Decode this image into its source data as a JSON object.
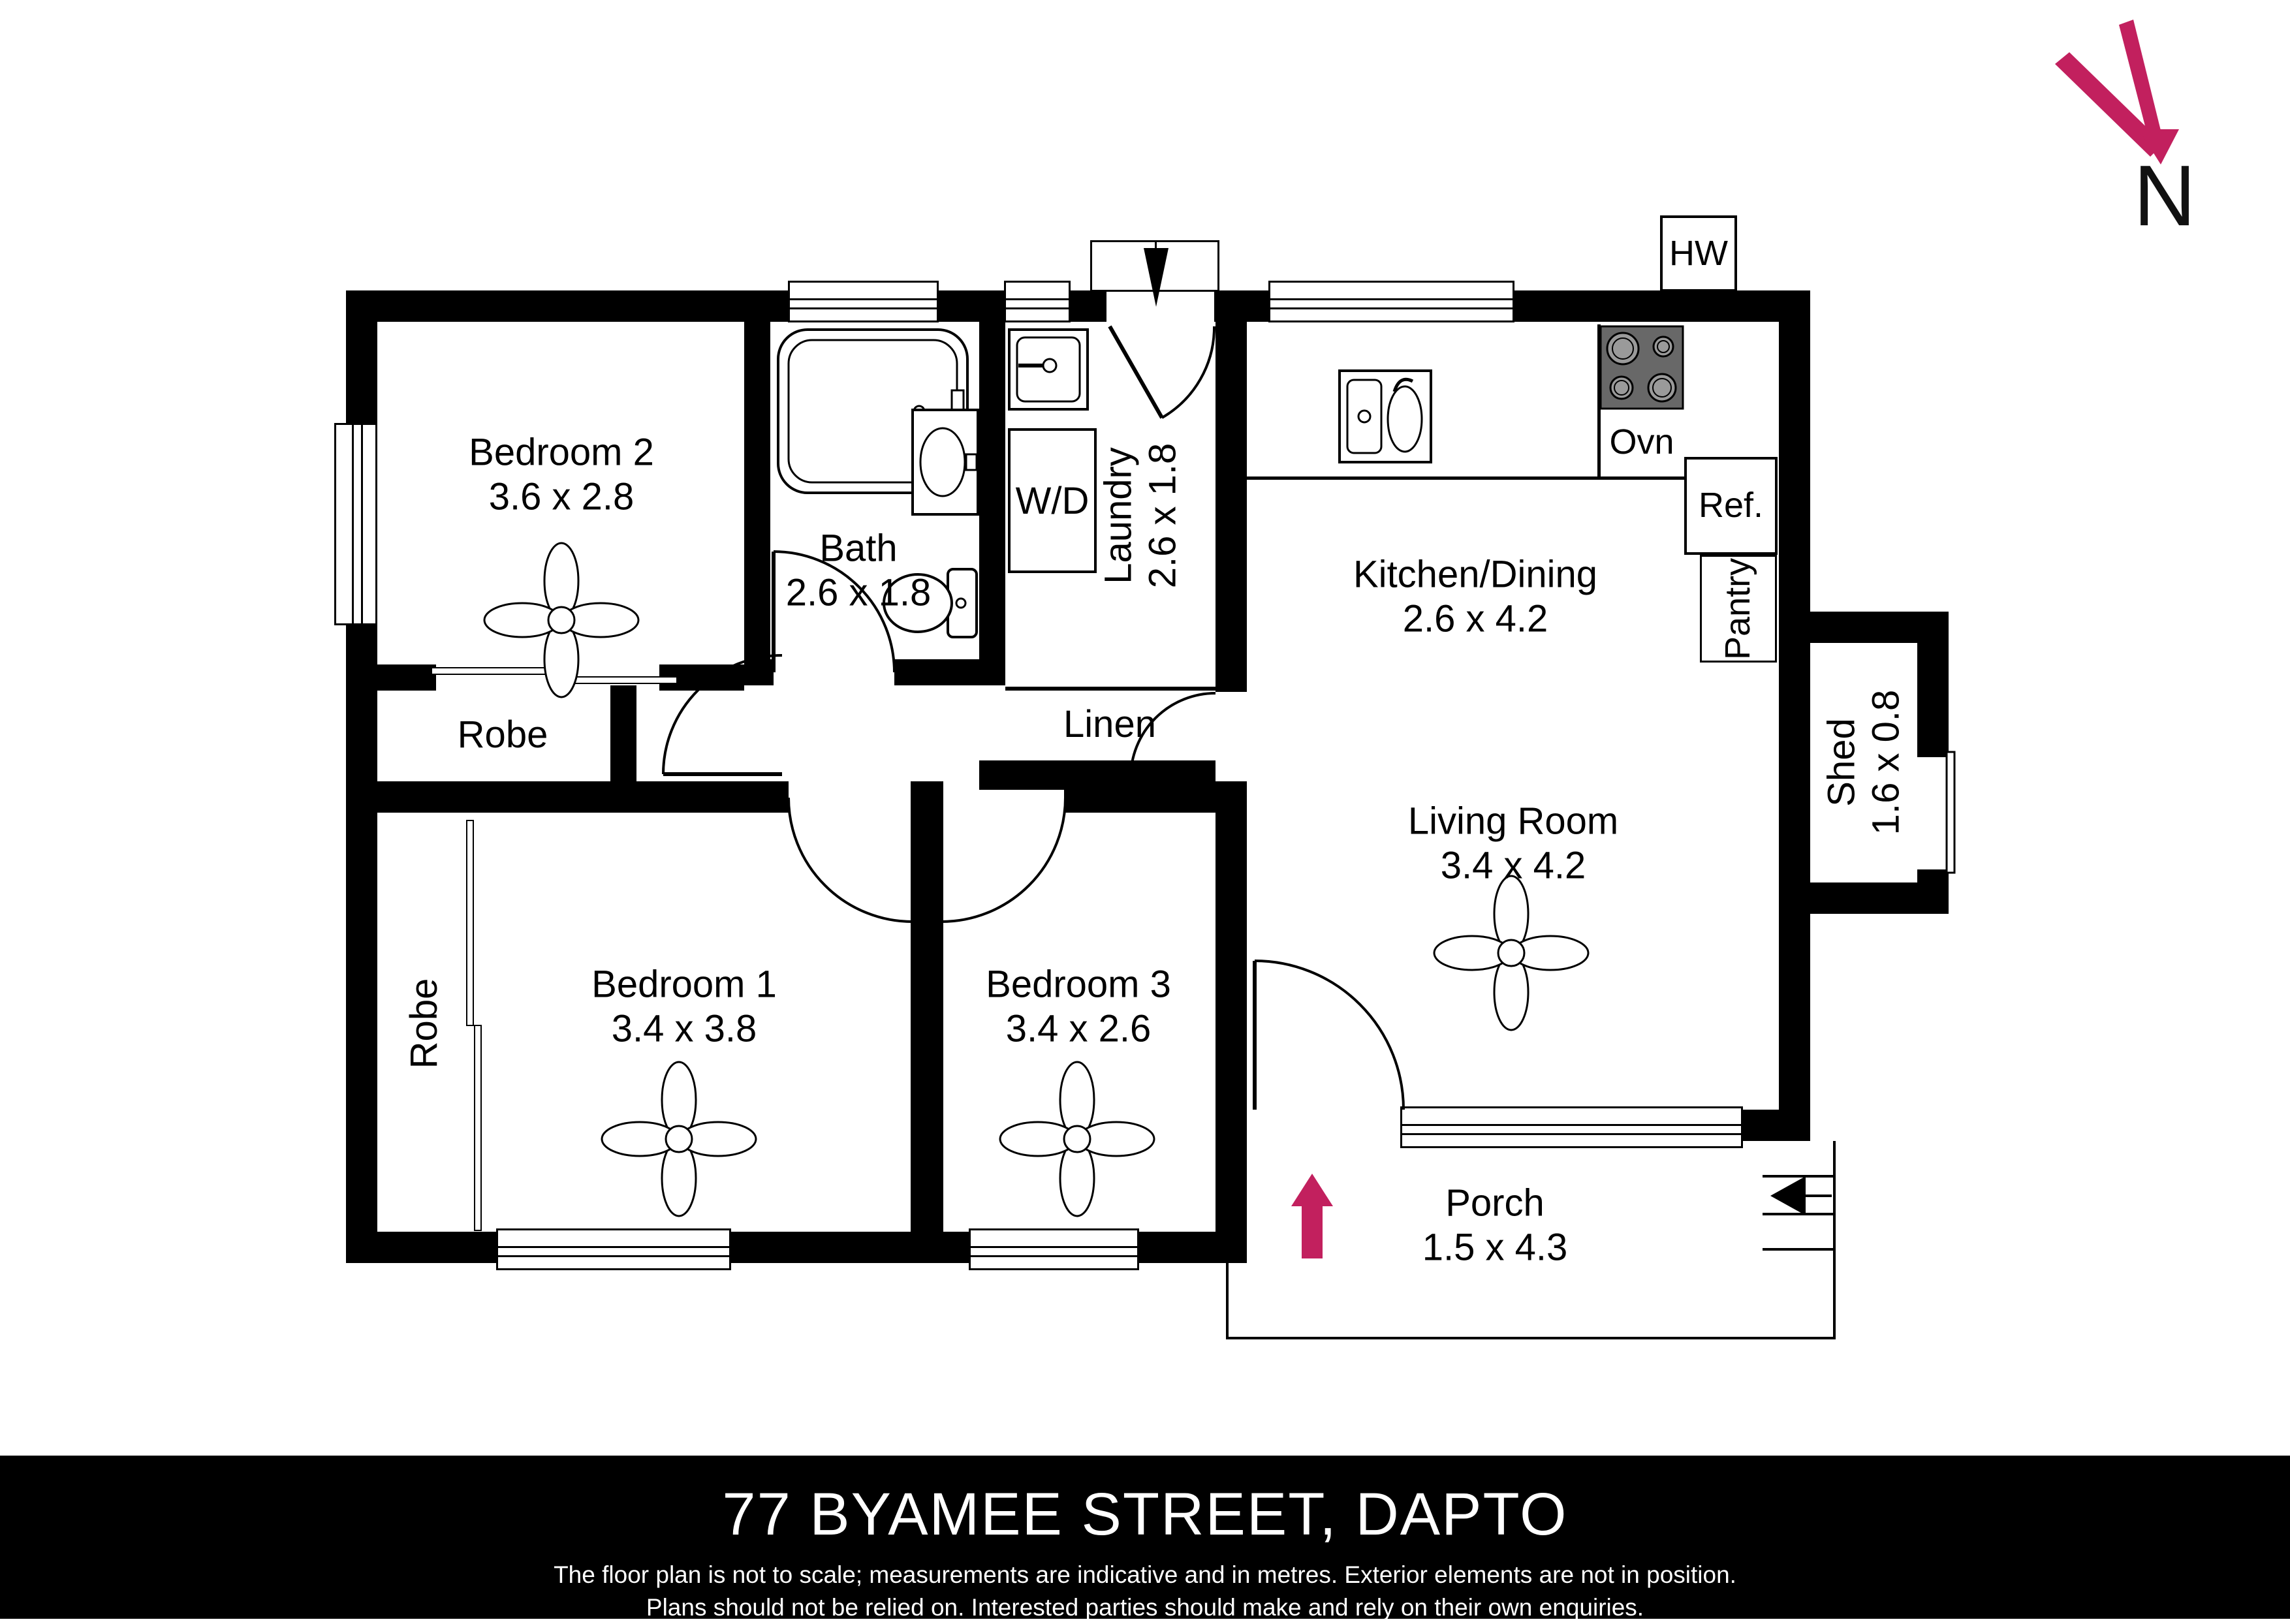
{
  "north": {
    "label": "N"
  },
  "rooms": [
    {
      "name": "Bedroom 2",
      "dims": "3.6 x 2.8"
    },
    {
      "name": "Bath",
      "dims": "2.6 x 1.8"
    },
    {
      "name": "Laundry",
      "dims": "2.6 x 1.8"
    },
    {
      "name": "Kitchen/Dining",
      "dims": "2.6 x 4.2"
    },
    {
      "name": "Living Room",
      "dims": "3.4 x 4.2"
    },
    {
      "name": "Bedroom 1",
      "dims": "3.4 x 3.8"
    },
    {
      "name": "Bedroom 3",
      "dims": "3.4 x 2.6"
    },
    {
      "name": "Porch",
      "dims": "1.5 x 4.3"
    },
    {
      "name": "Shed",
      "dims": "1.6 x 0.8"
    }
  ],
  "features": {
    "wd": "W/D",
    "linen": "Linen",
    "robe_bedroom2": "Robe",
    "robe_bedroom1": "Robe",
    "oven": "Ovn",
    "fridge": "Ref.",
    "pantry": "Pantry",
    "hot_water": "HW"
  },
  "footer": {
    "address": "77 BYAMEE STREET, DAPTO",
    "disclaimer_line1": "The floor plan is not to scale; measurements are indicative and in metres. Exterior elements are not in position.",
    "disclaimer_line2": "Plans should not be relied on. Interested parties should make and rely on their own enquiries."
  },
  "logo": {
    "brand": "“KNOCK-KNOCK”",
    "tagline": "REAL ESTATE"
  },
  "colors": {
    "accent": "#C2205E",
    "wall": "#000000",
    "cooktop": "#686868",
    "burner": "#9A9A9A"
  }
}
